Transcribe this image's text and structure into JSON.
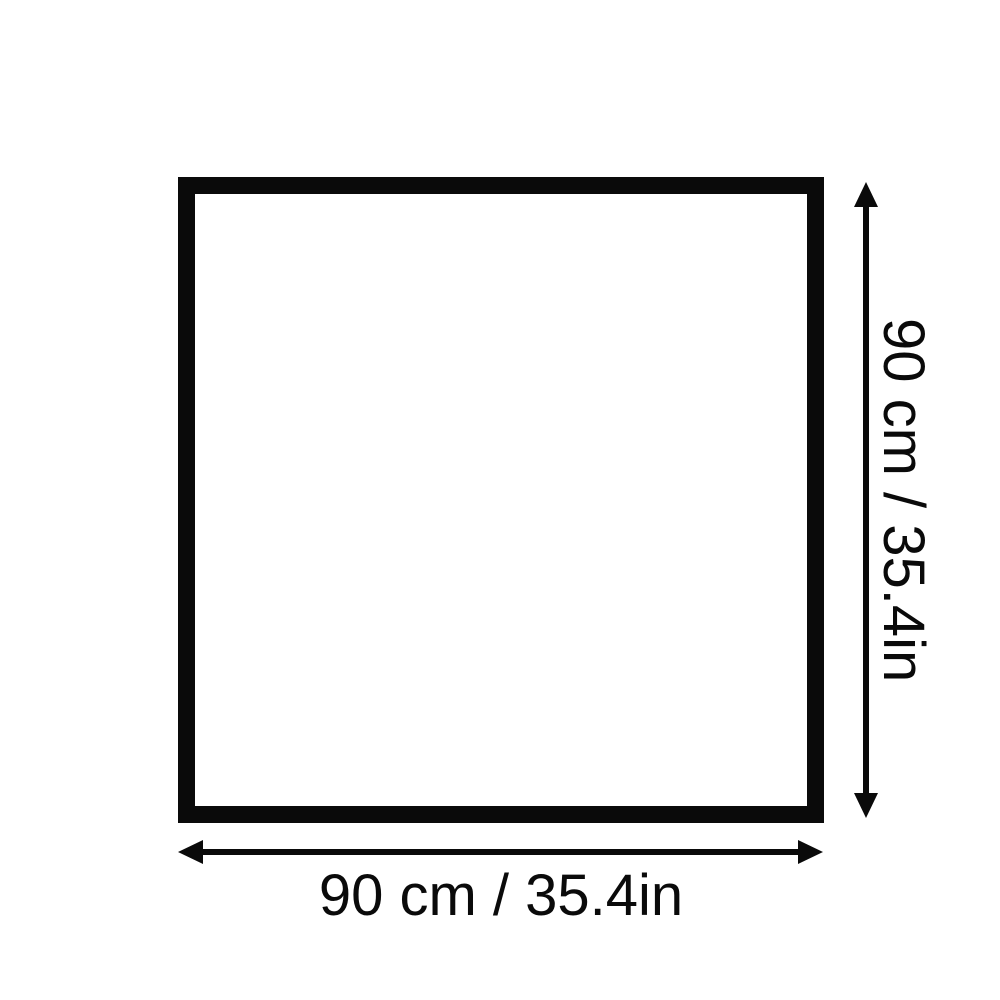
{
  "page": {
    "background_color": "#ffffff",
    "ink_color": "#0a0a0a"
  },
  "diagram": {
    "shape": "square-outline",
    "width_dimension": {
      "label": "90 cm / 35.4in",
      "value_cm": 90,
      "value_in": 35.4
    },
    "height_dimension": {
      "label": "90 cm / 35.4in",
      "value_cm": 90,
      "value_in": 35.4
    }
  }
}
